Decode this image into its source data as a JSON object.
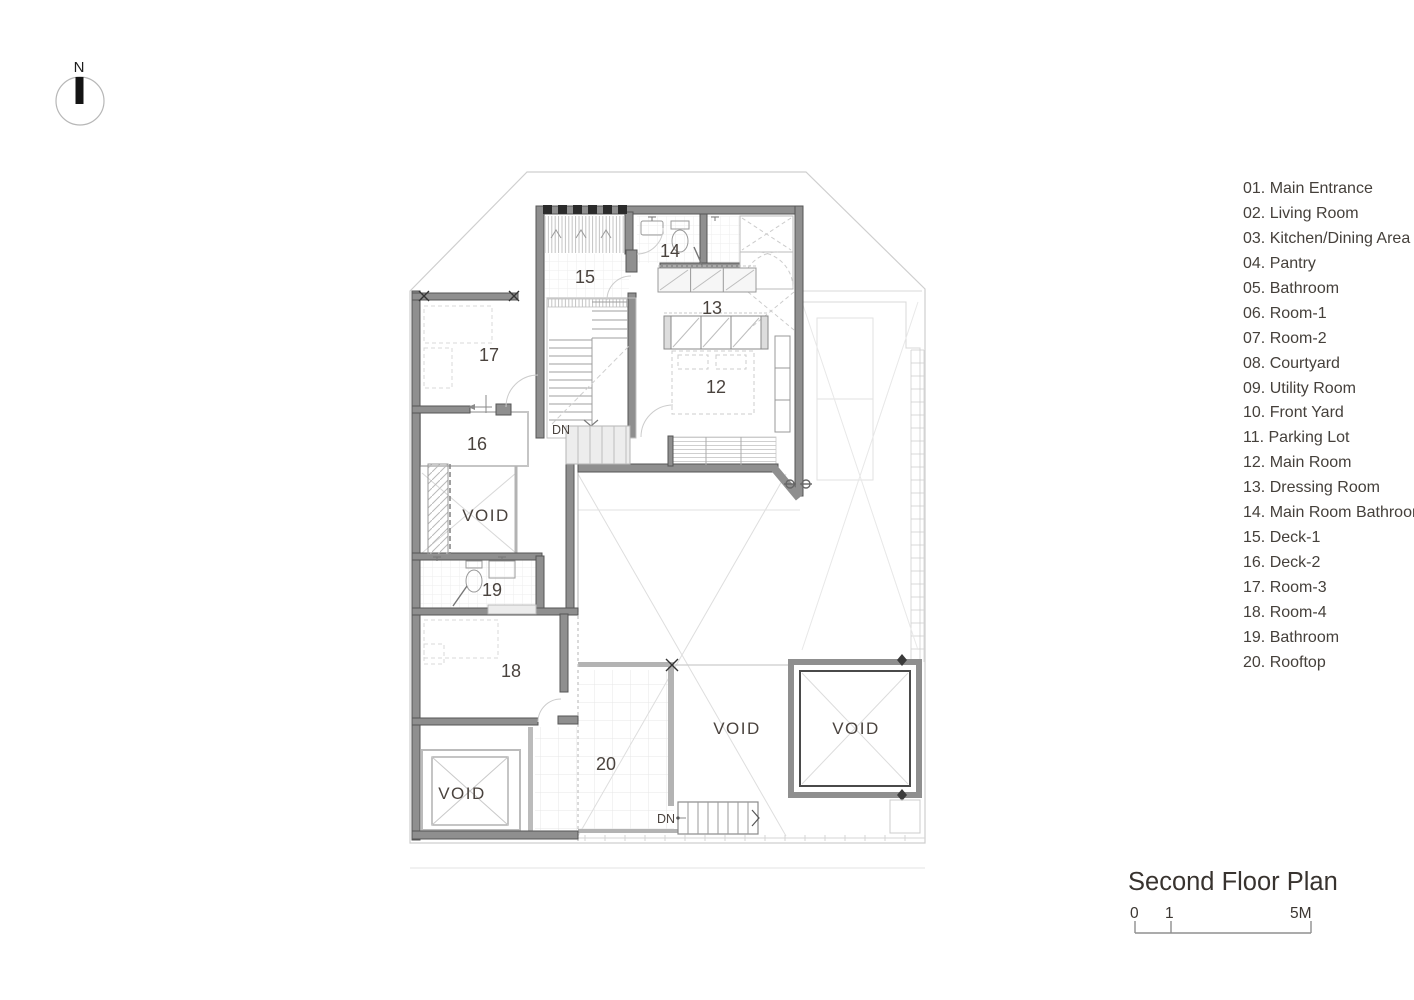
{
  "north_indicator": {
    "label": "N"
  },
  "title_block": {
    "title": "Second Floor Plan",
    "scale_ticks": [
      "0",
      "1",
      "5M"
    ]
  },
  "legend": {
    "items": [
      "01. Main Entrance",
      "02. Living Room",
      "03. Kitchen/Dining Area",
      "04. Pantry",
      "05. Bathroom",
      "06. Room-1",
      "07. Room-2",
      "08. Courtyard",
      "09. Utility Room",
      "10. Front Yard",
      "11. Parking Lot",
      "12. Main Room",
      "13. Dressing Room",
      "14. Main Room Bathroom",
      "15. Deck-1",
      "16. Deck-2",
      "17. Room-3",
      "18. Room-4",
      "19. Bathroom",
      "20. Rooftop"
    ]
  },
  "plan": {
    "labels": [
      {
        "text": "15",
        "x": 585,
        "y": 283,
        "kind": "room",
        "name": "room-label-15-deck-1"
      },
      {
        "text": "14",
        "x": 670,
        "y": 257,
        "kind": "room",
        "name": "room-label-14-main-room-bathroom"
      },
      {
        "text": "13",
        "x": 712,
        "y": 314,
        "kind": "room",
        "name": "room-label-13-dressing-room"
      },
      {
        "text": "12",
        "x": 716,
        "y": 393,
        "kind": "room",
        "name": "room-label-12-main-room"
      },
      {
        "text": "17",
        "x": 489,
        "y": 361,
        "kind": "room",
        "name": "room-label-17-room-3"
      },
      {
        "text": "16",
        "x": 477,
        "y": 450,
        "kind": "room",
        "name": "room-label-16-deck-2"
      },
      {
        "text": "19",
        "x": 492,
        "y": 596,
        "kind": "room",
        "name": "room-label-19-bathroom"
      },
      {
        "text": "18",
        "x": 511,
        "y": 677,
        "kind": "room",
        "name": "room-label-18-room-4"
      },
      {
        "text": "20",
        "x": 606,
        "y": 770,
        "kind": "room",
        "name": "room-label-20-rooftop"
      },
      {
        "text": "VOID",
        "x": 486,
        "y": 521,
        "kind": "void",
        "name": "void-label-west"
      },
      {
        "text": "VOID",
        "x": 462,
        "y": 799,
        "kind": "void",
        "name": "void-label-southwest"
      },
      {
        "text": "VOID",
        "x": 737,
        "y": 734,
        "kind": "void",
        "name": "void-label-center"
      },
      {
        "text": "VOID",
        "x": 856,
        "y": 734,
        "kind": "void",
        "name": "void-label-shaft"
      },
      {
        "text": "DN",
        "x": 561,
        "y": 434,
        "kind": "dn",
        "name": "stair-down-label-main"
      },
      {
        "text": "DN",
        "x": 666,
        "y": 823,
        "kind": "dn",
        "name": "stair-down-label-rooftop"
      }
    ]
  }
}
